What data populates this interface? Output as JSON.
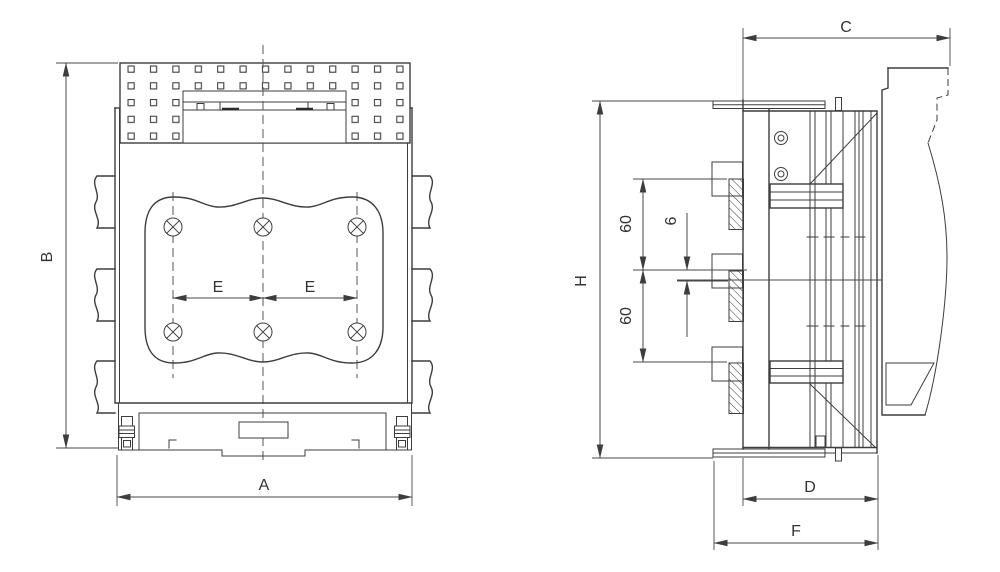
{
  "colors": {
    "line": "#3d3d3d",
    "background": "#ffffff"
  },
  "dimensions": {
    "A": "A",
    "B": "B",
    "C": "C",
    "D": "D",
    "E_left": "E",
    "E_right": "E",
    "F": "F",
    "H": "H",
    "terminal_spacing_upper": "60",
    "terminal_spacing_lower": "60",
    "terminal_thickness": "6"
  }
}
